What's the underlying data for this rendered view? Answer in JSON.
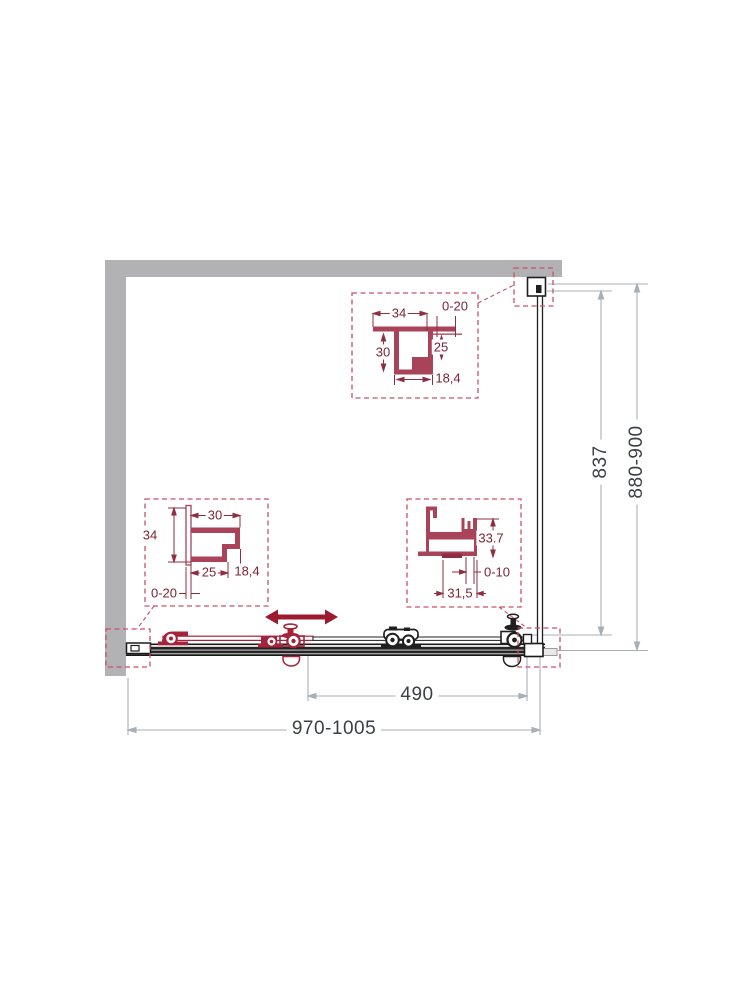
{
  "main_dimensions": {
    "overall_width": "970-1005",
    "door_opening": "490",
    "glass_height": "837",
    "overall_height": "880-900"
  },
  "top_profile_detail": {
    "flange_width": "34",
    "wall_adjust": "0-20",
    "channel_height": "30",
    "inner_height": "25",
    "channel_bottom": "18,4"
  },
  "left_profile_detail": {
    "top_width": "30",
    "overall_height": "34",
    "bottom_width": "25",
    "side_height": "18,4",
    "wall_adjust": "0-20"
  },
  "bottom_profile_detail": {
    "profile_height": "33.7",
    "glass_adjust": "0-10",
    "profile_width": "31,5"
  },
  "colors": {
    "wall_gray": "#b2b2b5",
    "drawing_black": "#1f1f1f",
    "accent_red": "#a72239",
    "arrow_red": "#9e1a2f",
    "profile_maroon": "#a8435a",
    "detail_line": "#8d2f42",
    "detail_text": "#7c2435",
    "callout_dashed": "#c9506a",
    "dim_line_gray": "#a9afb6",
    "dim_text": "#3b4046"
  }
}
